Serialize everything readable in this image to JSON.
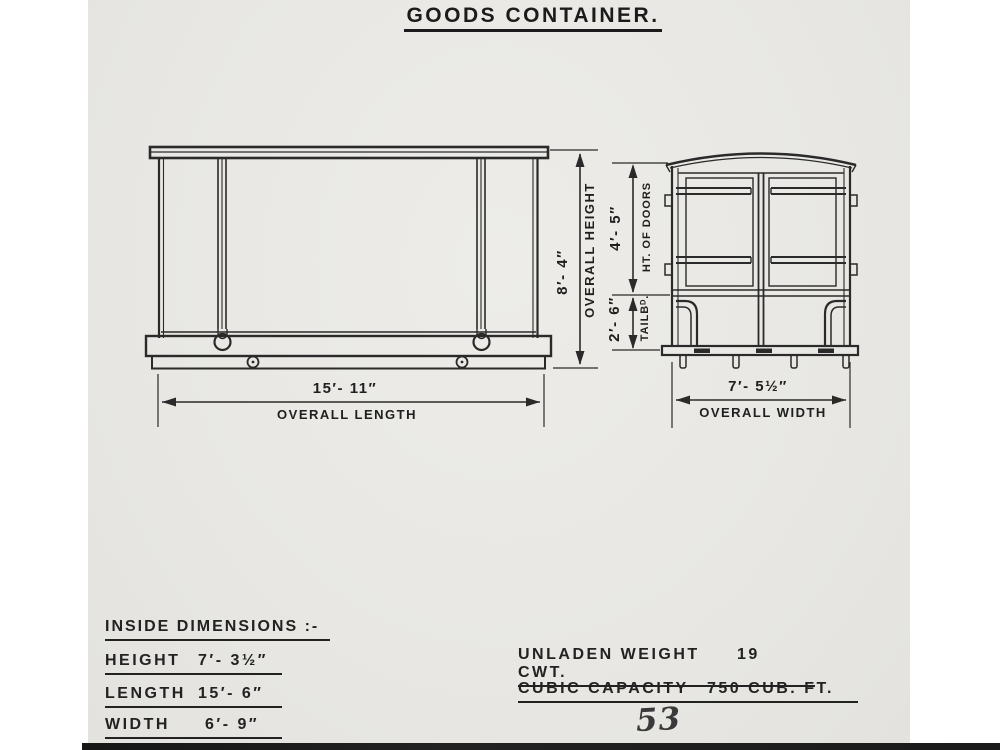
{
  "title": "GOODS CONTAINER.",
  "side_view": {
    "length_value": "15′- 11″",
    "length_label": "OVERALL LENGTH",
    "height_value": "8′- 4″",
    "height_label": "OVERALL HEIGHT"
  },
  "end_view": {
    "doors_value": "4′- 5″",
    "doors_label": "HT. OF DOORS",
    "tailboard_value": "2′- 6″",
    "tailboard_label": "TAILBᴰ.",
    "width_value": "7′- 5½″",
    "width_label": "OVERALL WIDTH"
  },
  "inside_dimensions": {
    "heading": "INSIDE DIMENSIONS :-",
    "rows": [
      {
        "label": "HEIGHT",
        "value": "7′- 3½″"
      },
      {
        "label": "LENGTH",
        "value": "15′- 6″"
      },
      {
        "label": "WIDTH",
        "value": "6′- 9″"
      }
    ]
  },
  "specs": {
    "rows": [
      {
        "label": "UNLADEN WEIGHT",
        "value": "19 CWT."
      },
      {
        "label": "CUBIC CAPACITY",
        "value": "750 CUB. FT."
      }
    ]
  },
  "page_number": "53",
  "colors": {
    "ink": "#242424",
    "paper": "#e9e8e5"
  }
}
